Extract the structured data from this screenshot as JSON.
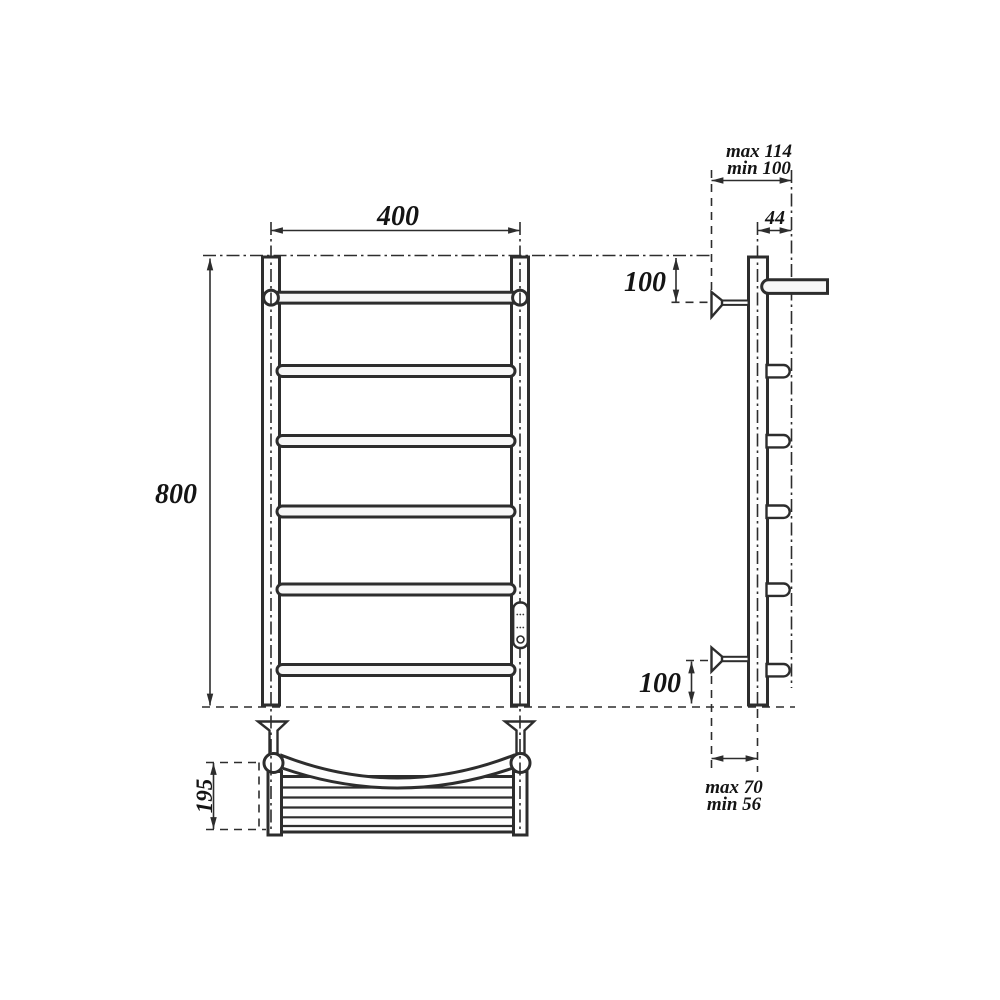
{
  "front_view": {
    "width": "400",
    "height": "800"
  },
  "plan_view": {
    "depth": "195"
  },
  "side_view": {
    "wall_offset_top_max": "max 114",
    "wall_offset_top_min": "min 100",
    "bar_end_offset": "44",
    "top_bracket_offset": "100",
    "bottom_bracket_offset": "100",
    "wall_offset_bottom_max": "max 70",
    "wall_offset_bottom_min": "min 56"
  }
}
